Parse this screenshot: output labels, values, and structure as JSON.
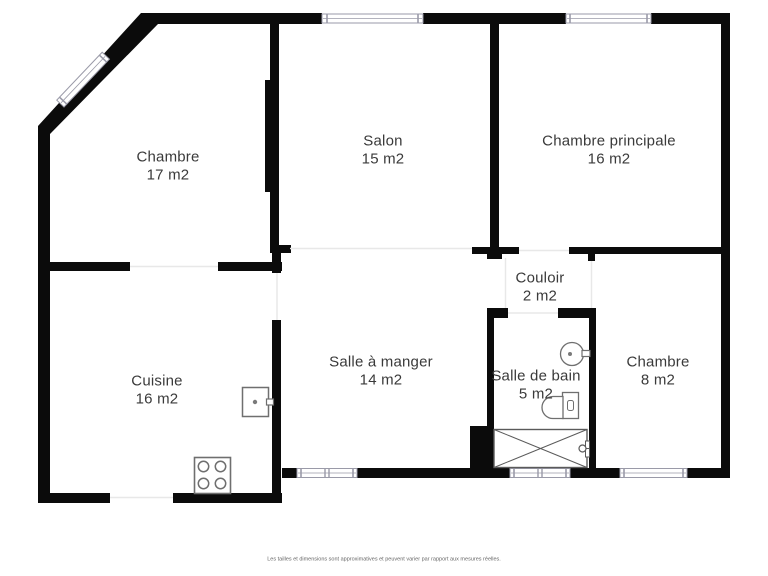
{
  "plan": {
    "rooms": [
      {
        "id": "chambre-1",
        "name": "Chambre",
        "area": "17 m2"
      },
      {
        "id": "salon",
        "name": "Salon",
        "area": "15 m2"
      },
      {
        "id": "chambre-principale",
        "name": "Chambre principale",
        "area": "16 m2"
      },
      {
        "id": "couloir",
        "name": "Couloir",
        "area": "2 m2"
      },
      {
        "id": "cuisine",
        "name": "Cuisine",
        "area": "16 m2"
      },
      {
        "id": "salle-a-manger",
        "name": "Salle à manger",
        "area": "14 m2"
      },
      {
        "id": "salle-de-bain",
        "name": "Salle de bain",
        "area": "5 m2"
      },
      {
        "id": "chambre-2",
        "name": "Chambre",
        "area": "8 m2"
      }
    ],
    "fixtures": [
      "stove-icon",
      "washing-machine-icon",
      "sink-icon",
      "toilet-icon",
      "bathtub-icon"
    ],
    "colors": {
      "wall": "#0b0b0b",
      "window_frame": "#9a9aa8",
      "fixture": "#6f6f6f",
      "opening": "#e8e8e8",
      "label_text": "#3a3a3a"
    },
    "disclaimer": "Les tailles et dimensions sont approximatives et peuvent varier par rapport aux mesures réelles."
  }
}
